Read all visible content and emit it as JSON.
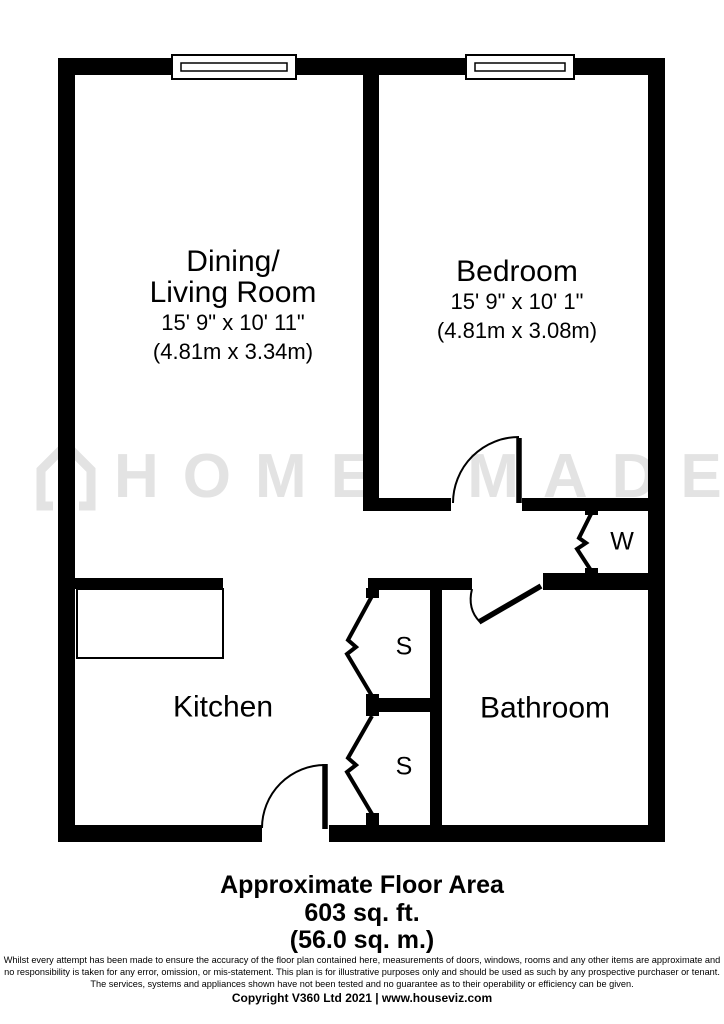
{
  "floorplan": {
    "watermark": {
      "brand": "HOME MADE"
    },
    "rooms": {
      "living": {
        "name_line1": "Dining/",
        "name_line2": "Living Room",
        "dims_imperial": "15' 9\" x 10' 11\"",
        "dims_metric": "(4.81m x 3.34m)"
      },
      "bedroom": {
        "name": "Bedroom",
        "dims_imperial": "15' 9\" x 10' 1\"",
        "dims_metric": "(4.81m x 3.08m)"
      },
      "kitchen": {
        "name": "Kitchen"
      },
      "bathroom": {
        "name": "Bathroom"
      },
      "wardrobe": {
        "label": "W"
      },
      "storage1": {
        "label": "S"
      },
      "storage2": {
        "label": "S"
      }
    },
    "footer": {
      "area_title": "Approximate Floor Area",
      "area_sqft": "603 sq. ft.",
      "area_sqm": "(56.0 sq. m.)",
      "disclaimer_line1": "Whilst every attempt has been made to ensure the accuracy of the floor plan contained here, measurements of doors, windows, rooms and any other items are approximate and",
      "disclaimer_line2": "no responsibility is taken for any error, omission, or mis-statement. This plan is for illustrative purposes only and should be used as such by any prospective purchaser or tenant.",
      "disclaimer_line3": "The services, systems and appliances shown have not been tested and no guarantee as to their operability or efficiency can be given.",
      "copyright": "Copyright V360 Ltd 2021 | www.houseviz.com"
    },
    "colors": {
      "wall": "#000000",
      "watermark": "#e3e3e3",
      "background": "#ffffff"
    }
  }
}
